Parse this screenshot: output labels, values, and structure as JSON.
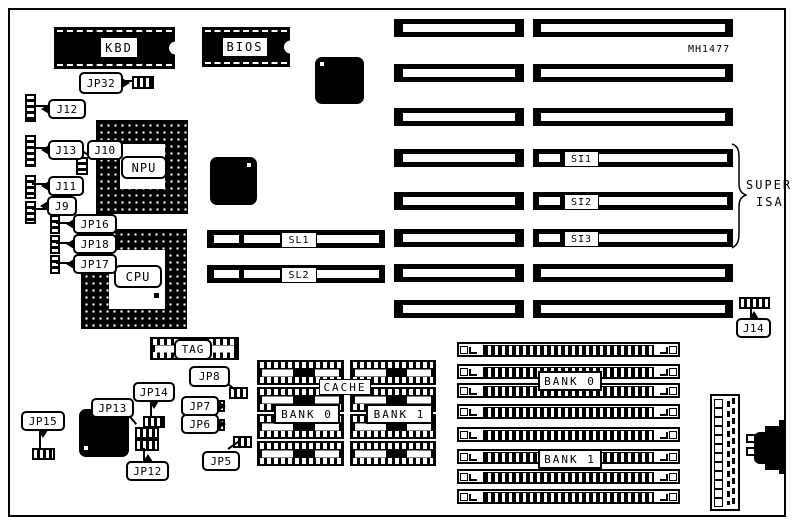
{
  "colors": {
    "ink": "#000000",
    "paper": "#ffffff"
  },
  "board": {
    "model": "MH1477",
    "super_isa": {
      "line1": "SUPER",
      "line2": "ISA"
    }
  },
  "chips": {
    "kbd": "KBD",
    "bios": "BIOS",
    "npu": "NPU",
    "cpu": "CPU",
    "tag": "TAG",
    "cache": {
      "title": "CACHE",
      "bank0": "BANK 0",
      "bank1": "BANK 1"
    }
  },
  "slots": {
    "sl1": "SL1",
    "sl2": "SL2",
    "si1": "SI1",
    "si2": "SI2",
    "si3": "SI3"
  },
  "memory": {
    "bank0": "BANK 0",
    "bank1": "BANK 1"
  },
  "jumpers": {
    "jp32": "JP32",
    "j12": "J12",
    "j13": "J13",
    "j10": "J10",
    "j11": "J11",
    "j9": "J9",
    "jp16": "JP16",
    "jp18": "JP18",
    "jp17": "JP17",
    "jp8": "JP8",
    "jp7": "JP7",
    "jp6": "JP6",
    "jp5": "JP5",
    "jp14": "JP14",
    "jp13": "JP13",
    "jp12": "JP12",
    "jp15": "JP15",
    "j14": "J14"
  }
}
